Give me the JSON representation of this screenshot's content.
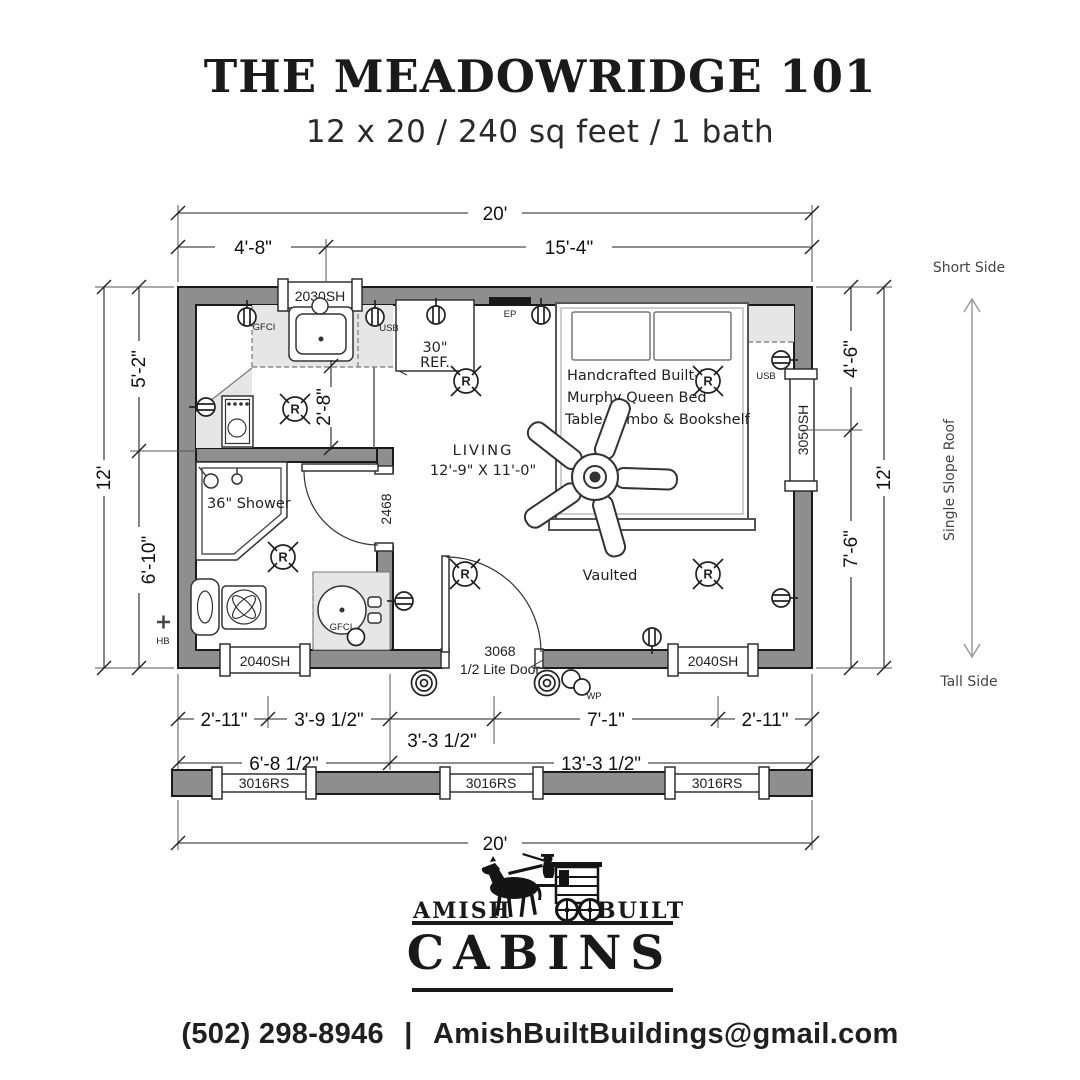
{
  "header": {
    "title": "THE MEADOWRIDGE 101",
    "subtitle": "12 x 20 / 240 sq feet / 1 bath"
  },
  "plan": {
    "dims": {
      "top_total": "20'",
      "top_left": "4'-8\"",
      "top_right": "15'-4\"",
      "left_total": "12'",
      "left_upper": "5'-2\"",
      "left_lower": "6'-10\"",
      "right_upper": "4'-6\"",
      "right_lower": "7'-6\"",
      "right_total": "12'",
      "bottom_row1": [
        "2'-11\"",
        "3'-9 1/2\"",
        "3'-3 1/2\"",
        "7'-1\"",
        "2'-11\""
      ],
      "bottom_row2_left": "6'-8 1/2\"",
      "bottom_row2_right": "13'-3 1/2\"",
      "bottom_total": "20'",
      "kitchen_clear": "2'-8\""
    },
    "windows": {
      "top": "2030SH",
      "right": "3050SH",
      "bottom_left": "2040SH",
      "bottom_right": "2040SH",
      "roof": [
        "3016RS",
        "3016RS",
        "3016RS"
      ]
    },
    "doors": {
      "interior": "2468",
      "entry_line1": "3068",
      "entry_line2": "1/2 Lite Door"
    },
    "rooms": {
      "living_label": "LIVING",
      "living_size": "12'-9\" X 11'-0\"",
      "vaulted": "Vaulted",
      "shower": "36\" Shower",
      "bed_line1": "Handcrafted Built-In",
      "bed_line2": "Murphy Queen Bed",
      "bed_line3": "Table Combo & Bookshelf",
      "ref_line1": "30\"",
      "ref_line2": "REF."
    },
    "electrical": {
      "gfci_kitchen": "GFCI",
      "gfci_bath": "GFCI",
      "usb_kitchen": "USB",
      "usb_bed": "USB",
      "ep": "EP",
      "wp": "WP",
      "hb": "HB",
      "recessed_symbol": "R"
    },
    "roof_side": {
      "short": "Short Side",
      "slope": "Single Slope Roof",
      "tall": "Tall Side"
    }
  },
  "footer": {
    "brand_left": "AMISH",
    "brand_right": "BUILT",
    "brand_main": "CABINS",
    "phone": "(502) 298-8946",
    "separator": "|",
    "email": "AmishBuiltBuildings@gmail.com"
  },
  "colors": {
    "ink": "#1a1a1a",
    "wall": "#8e8e8e",
    "counter": "#e6e6e6"
  }
}
